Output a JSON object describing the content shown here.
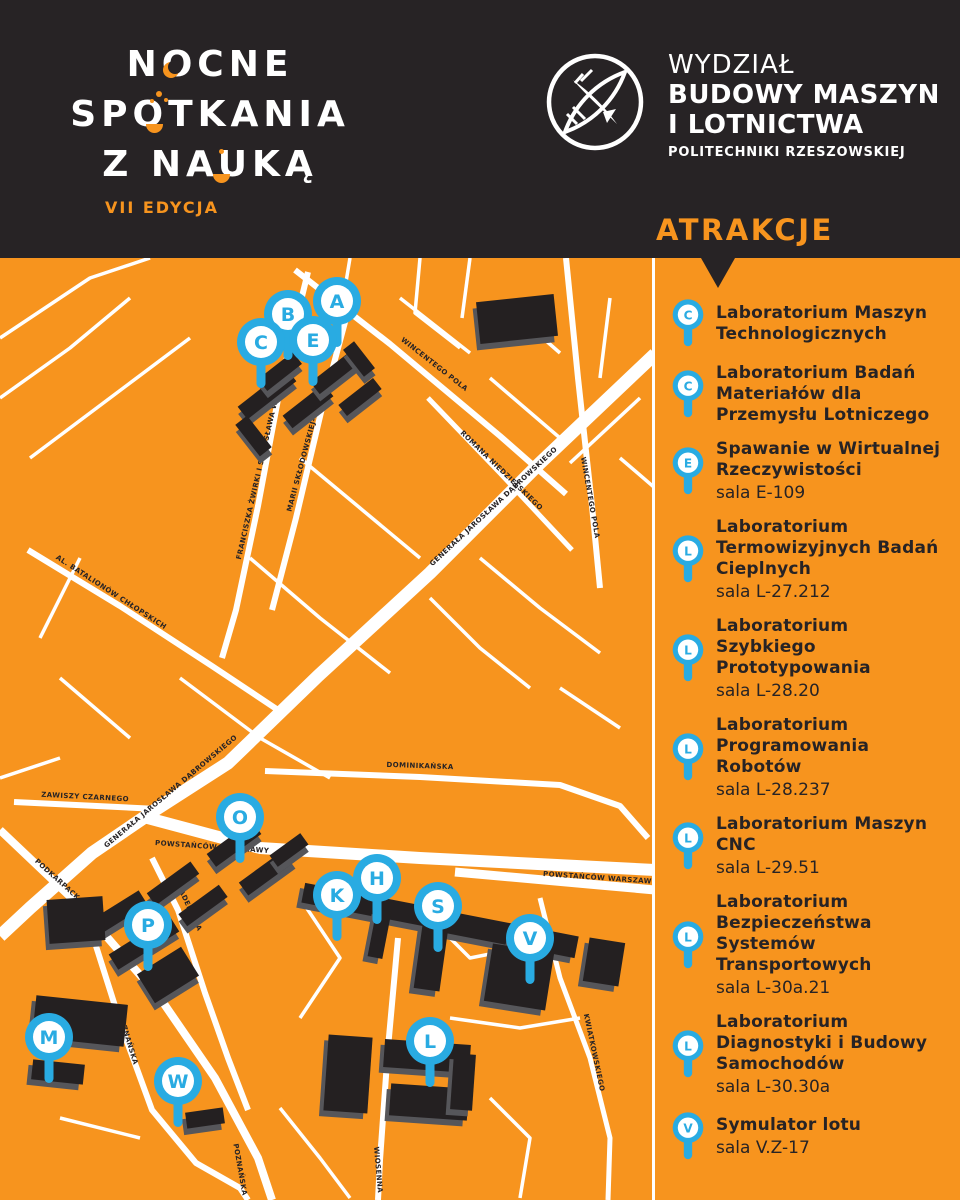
{
  "colors": {
    "orange": "#F7941E",
    "dark": "#272325",
    "blue": "#29ABE2",
    "white": "#ffffff",
    "building": "#242021",
    "buildingSide": "#56565A"
  },
  "header": {
    "title_lines": [
      "NOCNE",
      "SPOTKANIA",
      "Z NAUKĄ"
    ],
    "edition": "VII EDYCJA",
    "faculty": [
      "WYDZIAŁ",
      "BUDOWY MASZYN",
      "I LOTNICTWA",
      "POLITECHNIKI RZESZOWSKIEJ"
    ]
  },
  "sidebar": {
    "heading": "ATRAKCJE",
    "attractions": [
      {
        "letter": "C",
        "name": "Laboratorium Maszyn Technologicznych",
        "room": ""
      },
      {
        "letter": "C",
        "name": "Laboratorium Badań Materiałów dla Przemysłu Lotniczego",
        "room": ""
      },
      {
        "letter": "E",
        "name": "Spawanie w Wirtualnej Rzeczywistości",
        "room": "sala E-109"
      },
      {
        "letter": "L",
        "name": "Laboratorium Termowizyjnych Badań Cieplnych",
        "room": "sala L-27.212"
      },
      {
        "letter": "L",
        "name": "Laboratorium Szybkiego Prototypowania",
        "room": "sala L-28.20"
      },
      {
        "letter": "L",
        "name": "Laboratorium Programowania Robotów",
        "room": "sala L-28.237"
      },
      {
        "letter": "L",
        "name": "Laboratorium Maszyn CNC",
        "room": "sala L-29.51"
      },
      {
        "letter": "L",
        "name": "Laboratorium Bezpieczeństwa Systemów Transportowych",
        "room": "sala L-30a.21"
      },
      {
        "letter": "L",
        "name": "Laboratorium Diagnostyki i Budowy Samochodów",
        "room": "sala L-30.30a"
      },
      {
        "letter": "V",
        "name": "Symulator lotu",
        "room": "sala V.Z-17"
      }
    ]
  },
  "map": {
    "streets": [
      {
        "w": 13,
        "pts": [
          [
            655,
            96
          ],
          [
            540,
            205
          ],
          [
            430,
            315
          ],
          [
            318,
            418
          ],
          [
            228,
            505
          ],
          [
            158,
            550
          ],
          [
            92,
            595
          ],
          [
            30,
            650
          ],
          [
            0,
            678
          ]
        ]
      },
      {
        "w": 12,
        "pts": [
          [
            140,
            558
          ],
          [
            260,
            590
          ],
          [
            420,
            600
          ],
          [
            655,
            612
          ]
        ]
      },
      {
        "w": 9,
        "pts": [
          [
            455,
            614
          ],
          [
            655,
            632
          ]
        ]
      },
      {
        "w": 8,
        "pts": [
          [
            0,
            572
          ],
          [
            80,
            648
          ],
          [
            160,
            740
          ],
          [
            215,
            820
          ],
          [
            258,
            900
          ],
          [
            272,
            942
          ]
        ]
      },
      {
        "w": 6,
        "pts": [
          [
            295,
            12
          ],
          [
            390,
            86
          ],
          [
            500,
            178
          ],
          [
            566,
            236
          ]
        ]
      },
      {
        "w": 6,
        "pts": [
          [
            566,
            0
          ],
          [
            578,
            120
          ],
          [
            592,
            248
          ],
          [
            600,
            330
          ]
        ]
      },
      {
        "w": 6,
        "pts": [
          [
            308,
            14
          ],
          [
            282,
            120
          ],
          [
            258,
            248
          ],
          [
            236,
            352
          ],
          [
            222,
            400
          ]
        ]
      },
      {
        "w": 6,
        "pts": [
          [
            352,
            38
          ],
          [
            322,
            150
          ],
          [
            296,
            260
          ],
          [
            272,
            352
          ]
        ]
      },
      {
        "w": 5,
        "pts": [
          [
            428,
            140
          ],
          [
            500,
            215
          ],
          [
            572,
            292
          ]
        ]
      },
      {
        "w": 6,
        "pts": [
          [
            28,
            292
          ],
          [
            120,
            348
          ],
          [
            212,
            408
          ],
          [
            278,
            452
          ]
        ]
      },
      {
        "w": 6,
        "pts": [
          [
            14,
            544
          ],
          [
            158,
            551
          ]
        ]
      },
      {
        "w": 6,
        "pts": [
          [
            152,
            600
          ],
          [
            178,
            652
          ],
          [
            205,
            735
          ],
          [
            228,
            800
          ],
          [
            248,
            852
          ]
        ]
      },
      {
        "w": 6,
        "pts": [
          [
            96,
            688
          ],
          [
            122,
            770
          ],
          [
            152,
            852
          ],
          [
            196,
            905
          ],
          [
            240,
            930
          ],
          [
            248,
            942
          ]
        ]
      },
      {
        "w": 6,
        "pts": [
          [
            265,
            513
          ],
          [
            420,
            519
          ],
          [
            560,
            527
          ],
          [
            620,
            548
          ],
          [
            648,
            580
          ]
        ]
      },
      {
        "w": 6,
        "pts": [
          [
            398,
            680
          ],
          [
            388,
            790
          ],
          [
            380,
            902
          ],
          [
            378,
            942
          ]
        ]
      },
      {
        "w": 5,
        "pts": [
          [
            540,
            640
          ],
          [
            560,
            720
          ],
          [
            590,
            800
          ],
          [
            610,
            880
          ],
          [
            608,
            942
          ]
        ]
      },
      {
        "w": 3.5,
        "pts": [
          [
            350,
            0
          ],
          [
            340,
            60
          ],
          [
            332,
            120
          ]
        ]
      },
      {
        "w": 3.5,
        "pts": [
          [
            400,
            40
          ],
          [
            470,
            95
          ]
        ]
      },
      {
        "w": 3.5,
        "pts": [
          [
            420,
            0
          ],
          [
            415,
            55
          ],
          [
            460,
            90
          ]
        ]
      },
      {
        "w": 3.5,
        "pts": [
          [
            470,
            0
          ],
          [
            462,
            60
          ]
        ]
      },
      {
        "w": 3.5,
        "pts": [
          [
            520,
            60
          ],
          [
            560,
            95
          ]
        ]
      },
      {
        "w": 3.5,
        "pts": [
          [
            610,
            40
          ],
          [
            600,
            120
          ]
        ]
      },
      {
        "w": 3.5,
        "pts": [
          [
            640,
            140
          ],
          [
            570,
            205
          ]
        ]
      },
      {
        "w": 3.5,
        "pts": [
          [
            300,
            200
          ],
          [
            360,
            250
          ],
          [
            420,
            300
          ]
        ]
      },
      {
        "w": 3.5,
        "pts": [
          [
            250,
            300
          ],
          [
            320,
            360
          ],
          [
            390,
            415
          ]
        ]
      },
      {
        "w": 3.5,
        "pts": [
          [
            180,
            420
          ],
          [
            260,
            480
          ],
          [
            330,
            520
          ]
        ]
      },
      {
        "w": 3.5,
        "pts": [
          [
            80,
            300
          ],
          [
            40,
            380
          ]
        ]
      },
      {
        "w": 3.5,
        "pts": [
          [
            60,
            420
          ],
          [
            130,
            480
          ]
        ]
      },
      {
        "w": 3.5,
        "pts": [
          [
            0,
            520
          ],
          [
            60,
            500
          ]
        ]
      },
      {
        "w": 3.5,
        "pts": [
          [
            430,
            340
          ],
          [
            480,
            390
          ],
          [
            530,
            430
          ]
        ]
      },
      {
        "w": 3.5,
        "pts": [
          [
            480,
            300
          ],
          [
            540,
            350
          ],
          [
            600,
            395
          ]
        ]
      },
      {
        "w": 3.5,
        "pts": [
          [
            560,
            430
          ],
          [
            620,
            470
          ]
        ]
      },
      {
        "w": 3.5,
        "pts": [
          [
            300,
            640
          ],
          [
            340,
            700
          ],
          [
            300,
            760
          ]
        ]
      },
      {
        "w": 3.5,
        "pts": [
          [
            430,
            660
          ],
          [
            470,
            700
          ],
          [
            520,
            690
          ]
        ]
      },
      {
        "w": 3.5,
        "pts": [
          [
            60,
            860
          ],
          [
            140,
            880
          ]
        ]
      },
      {
        "w": 3.5,
        "pts": [
          [
            280,
            850
          ],
          [
            320,
            900
          ],
          [
            350,
            940
          ]
        ]
      },
      {
        "w": 3.5,
        "pts": [
          [
            450,
            760
          ],
          [
            520,
            770
          ],
          [
            580,
            760
          ]
        ]
      },
      {
        "w": 3.5,
        "pts": [
          [
            490,
            840
          ],
          [
            530,
            880
          ],
          [
            520,
            940
          ]
        ]
      },
      {
        "w": 3.5,
        "pts": [
          [
            0,
            80
          ],
          [
            90,
            20
          ],
          [
            150,
            0
          ]
        ]
      },
      {
        "w": 3.5,
        "pts": [
          [
            0,
            140
          ],
          [
            70,
            90
          ],
          [
            130,
            40
          ]
        ]
      },
      {
        "w": 3.5,
        "pts": [
          [
            30,
            200
          ],
          [
            110,
            140
          ],
          [
            190,
            80
          ]
        ]
      },
      {
        "w": 3.5,
        "pts": [
          [
            490,
            120
          ],
          [
            560,
            180
          ]
        ]
      },
      {
        "w": 3.5,
        "pts": [
          [
            620,
            200
          ],
          [
            655,
            230
          ]
        ]
      }
    ],
    "labels": [
      {
        "t": "WINCENTEGO POLA",
        "x": 433,
        "y": 108,
        "a": 38
      },
      {
        "t": "ROMANA NIEDZIELSKIEGO",
        "x": 500,
        "y": 214,
        "a": 44
      },
      {
        "t": "WINCENTEGO POLA",
        "x": 588,
        "y": 240,
        "a": 80
      },
      {
        "t": "FRANCISZKA ŻWIRKI I STANISŁAWA WIGURY",
        "x": 262,
        "y": 210,
        "a": -77
      },
      {
        "t": "MARII SKŁODOWSKIEJ-CURIE",
        "x": 307,
        "y": 195,
        "a": -75
      },
      {
        "t": "GENERAŁA JAROSŁAWA DĄBROWSKIEGO",
        "x": 495,
        "y": 250,
        "a": -43
      },
      {
        "t": "GENERAŁA JAROSŁAWA DĄBROWSKIEGO",
        "x": 172,
        "y": 535,
        "a": -40
      },
      {
        "t": "ZAWISZY CZARNEGO",
        "x": 85,
        "y": 541,
        "a": 3
      },
      {
        "t": "POWSTAŃCÓW WARSZAWY",
        "x": 212,
        "y": 591,
        "a": 4
      },
      {
        "t": "POWSTAŃCÓW WARSZAWY",
        "x": 600,
        "y": 622,
        "a": 4
      },
      {
        "t": "AL. BATALIONÓW CHŁOPSKICH",
        "x": 110,
        "y": 336,
        "a": 33
      },
      {
        "t": "PODKARPACKA",
        "x": 58,
        "y": 625,
        "a": 42
      },
      {
        "t": "AKADEMICKA",
        "x": 186,
        "y": 648,
        "a": 65
      },
      {
        "t": "POZNAŃSKA",
        "x": 126,
        "y": 782,
        "a": 73
      },
      {
        "t": "POZNAŃSKA",
        "x": 238,
        "y": 912,
        "a": 80
      },
      {
        "t": "WIOSENNA",
        "x": 376,
        "y": 912,
        "a": 85
      },
      {
        "t": "DOMINIKAŃSKA",
        "x": 420,
        "y": 510,
        "a": 2
      },
      {
        "t": "KWIATKOWSKIEGO",
        "x": 592,
        "y": 795,
        "a": 78
      }
    ],
    "buildings": [
      {
        "x": 236,
        "y": 128,
        "w": 62,
        "h": 16,
        "r": -38
      },
      {
        "x": 258,
        "y": 106,
        "w": 44,
        "h": 15,
        "r": -38
      },
      {
        "x": 282,
        "y": 140,
        "w": 52,
        "h": 16,
        "r": -38
      },
      {
        "x": 310,
        "y": 108,
        "w": 48,
        "h": 15,
        "r": -38
      },
      {
        "x": 338,
        "y": 132,
        "w": 44,
        "h": 14,
        "r": -38
      },
      {
        "x": 246,
        "y": 158,
        "w": 15,
        "h": 40,
        "r": -38
      },
      {
        "x": 352,
        "y": 84,
        "w": 14,
        "h": 34,
        "r": -38
      },
      {
        "x": 478,
        "y": 40,
        "w": 78,
        "h": 42,
        "r": -6
      },
      {
        "x": 206,
        "y": 578,
        "w": 56,
        "h": 16,
        "r": -36
      },
      {
        "x": 238,
        "y": 606,
        "w": 58,
        "h": 16,
        "r": -36
      },
      {
        "x": 270,
        "y": 585,
        "w": 38,
        "h": 14,
        "r": -36
      },
      {
        "x": 302,
        "y": 638,
        "w": 140,
        "h": 20,
        "r": 11
      },
      {
        "x": 428,
        "y": 664,
        "w": 150,
        "h": 22,
        "r": 11
      },
      {
        "x": 372,
        "y": 652,
        "w": 15,
        "h": 48,
        "r": 11
      },
      {
        "x": 508,
        "y": 668,
        "w": 17,
        "h": 56,
        "r": 11
      },
      {
        "x": 418,
        "y": 668,
        "w": 26,
        "h": 64,
        "r": 8
      },
      {
        "x": 488,
        "y": 690,
        "w": 62,
        "h": 58,
        "r": 9
      },
      {
        "x": 586,
        "y": 682,
        "w": 36,
        "h": 44,
        "r": 9
      },
      {
        "x": 84,
        "y": 648,
        "w": 64,
        "h": 17,
        "r": -32
      },
      {
        "x": 108,
        "y": 676,
        "w": 72,
        "h": 18,
        "r": -32
      },
      {
        "x": 142,
        "y": 700,
        "w": 52,
        "h": 34,
        "r": -32
      },
      {
        "x": 48,
        "y": 640,
        "w": 56,
        "h": 44,
        "r": -4
      },
      {
        "x": 146,
        "y": 618,
        "w": 54,
        "h": 15,
        "r": -36
      },
      {
        "x": 178,
        "y": 640,
        "w": 50,
        "h": 15,
        "r": -36
      },
      {
        "x": 34,
        "y": 742,
        "w": 92,
        "h": 42,
        "r": 6
      },
      {
        "x": 32,
        "y": 804,
        "w": 52,
        "h": 20,
        "r": 6
      },
      {
        "x": 326,
        "y": 778,
        "w": 44,
        "h": 76,
        "r": 4
      },
      {
        "x": 384,
        "y": 784,
        "w": 86,
        "h": 28,
        "r": 4
      },
      {
        "x": 390,
        "y": 828,
        "w": 78,
        "h": 32,
        "r": 4
      },
      {
        "x": 452,
        "y": 796,
        "w": 22,
        "h": 56,
        "r": 4
      },
      {
        "x": 186,
        "y": 852,
        "w": 38,
        "h": 16,
        "r": -8
      }
    ],
    "pins": [
      {
        "letter": "A",
        "x": 337,
        "y": 43
      },
      {
        "letter": "B",
        "x": 288,
        "y": 56
      },
      {
        "letter": "E",
        "x": 313,
        "y": 82
      },
      {
        "letter": "C",
        "x": 261,
        "y": 84
      },
      {
        "letter": "O",
        "x": 240,
        "y": 559
      },
      {
        "letter": "H",
        "x": 377,
        "y": 620
      },
      {
        "letter": "K",
        "x": 337,
        "y": 637
      },
      {
        "letter": "S",
        "x": 438,
        "y": 648
      },
      {
        "letter": "P",
        "x": 148,
        "y": 667
      },
      {
        "letter": "V",
        "x": 530,
        "y": 680
      },
      {
        "letter": "M",
        "x": 49,
        "y": 779
      },
      {
        "letter": "L",
        "x": 430,
        "y": 783
      },
      {
        "letter": "W",
        "x": 178,
        "y": 823
      }
    ]
  }
}
